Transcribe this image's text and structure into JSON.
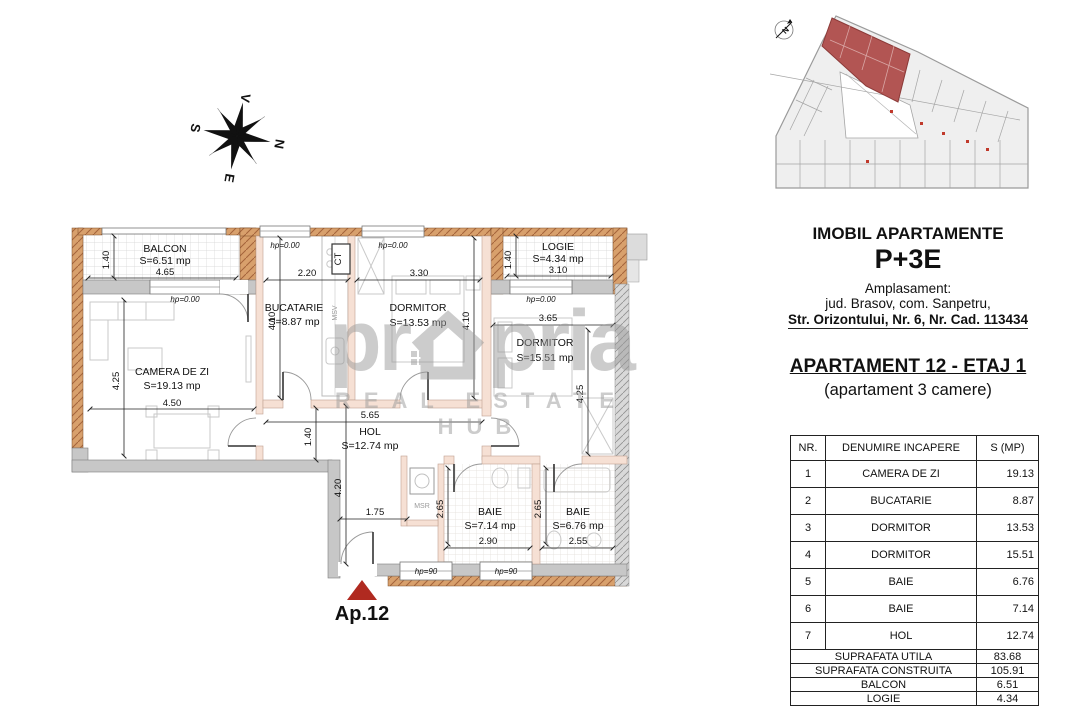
{
  "compass": {
    "north": "N",
    "south": "S",
    "east": "E",
    "west": "V"
  },
  "site_plan": {
    "north_label": "N"
  },
  "watermark": {
    "prefix": "pr",
    "suffix": "pria",
    "tagline": "REAL ESTATE HUB"
  },
  "info_panel": {
    "building_title": "IMOBIL APARTAMENTE",
    "regime": "P+3E",
    "location_label": "Amplasament:",
    "location_line1": "jud. Brasov, com. Sanpetru,",
    "location_line2": "Str. Orizontului, Nr. 6, Nr. Cad. 113434",
    "apartment_title": "APARTAMENT 12 - ETAJ 1",
    "apartment_subtitle": "(apartament 3 camere)"
  },
  "area_table": {
    "headers": [
      "NR.",
      "DENUMIRE INCAPERE",
      "S (MP)"
    ],
    "rows": [
      [
        "1",
        "CAMERA DE ZI",
        "19.13"
      ],
      [
        "2",
        "BUCATARIE",
        "8.87"
      ],
      [
        "3",
        "DORMITOR",
        "13.53"
      ],
      [
        "4",
        "DORMITOR",
        "15.51"
      ],
      [
        "5",
        "BAIE",
        "6.76"
      ],
      [
        "6",
        "BAIE",
        "7.14"
      ],
      [
        "7",
        "HOL",
        "12.74"
      ]
    ],
    "summary": [
      [
        "SUPRAFATA UTILA",
        "83.68"
      ],
      [
        "SUPRAFATA CONSTRUITA",
        "105.91"
      ],
      [
        "BALCON",
        "6.51"
      ],
      [
        "LOGIE",
        "4.34"
      ]
    ]
  },
  "floor_plan": {
    "apartment_label": "Ap.12",
    "rooms": [
      {
        "name": "BALCON",
        "area": "S=6.51 mp",
        "w": "4.65",
        "h": "1.40"
      },
      {
        "name": "CAMERA DE ZI",
        "area": "S=19.13 mp",
        "w": "4.50",
        "h": "4.25"
      },
      {
        "name": "BUCATARIE",
        "area": "S=8.87 mp",
        "w": "2.20",
        "h": "4.10"
      },
      {
        "name": "DORMITOR",
        "area": "S=13.53 mp",
        "w": "3.30",
        "h": "4.10"
      },
      {
        "name": "LOGIE",
        "area": "S=4.34 mp",
        "w": "3.10",
        "h": "1.40"
      },
      {
        "name": "DORMITOR",
        "area": "S=15.51 mp",
        "w": "3.65",
        "h": "4.25"
      },
      {
        "name": "HOL",
        "area": "S=12.74 mp",
        "w": "5.65",
        "h": "1.40",
        "leg": "4.20",
        "entry": "1.75"
      },
      {
        "name": "BAIE",
        "area": "S=7.14 mp",
        "w": "2.90",
        "h": "2.65"
      },
      {
        "name": "BAIE",
        "area": "S=6.76 mp",
        "w": "2.55",
        "h": "2.65"
      }
    ],
    "labels": {
      "hp0": "hp=0.00",
      "hp90": "hp=90",
      "ct": "CT",
      "msv": "MSV",
      "msr": "MSR"
    }
  },
  "colors": {
    "highlight": "#b02a20",
    "brick": "#d8a06c",
    "wall_gray": "#c7c7c7",
    "partition": "#f6e0d4"
  }
}
